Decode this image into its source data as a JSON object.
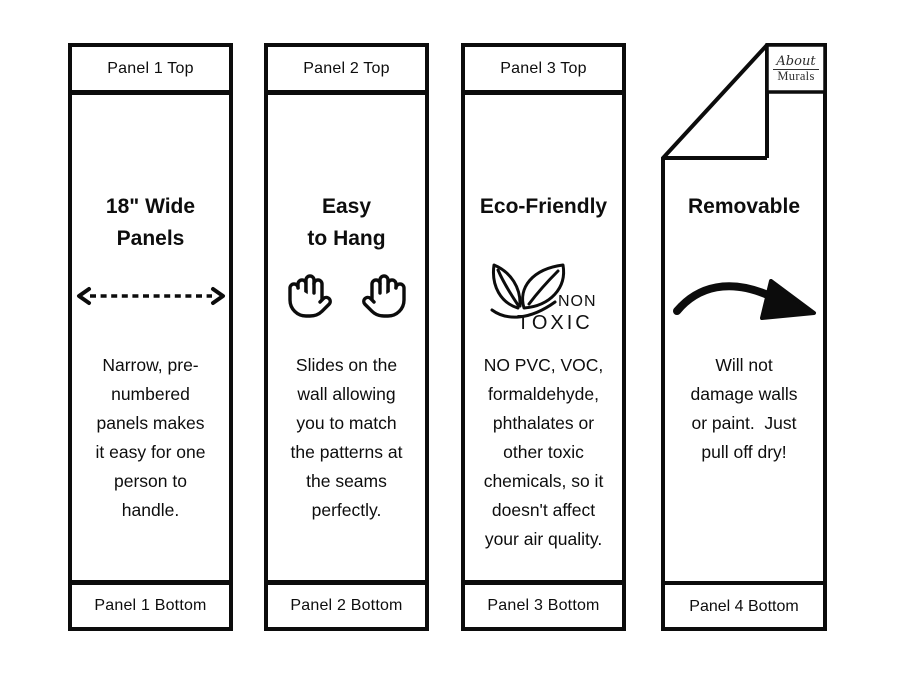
{
  "page": {
    "background": "#ffffff",
    "ink": "#0c0c0c"
  },
  "panels": [
    {
      "top_label": "Panel 1 Top",
      "title": "18\" Wide\nPanels",
      "icon": "width-arrow-icon",
      "body": "Narrow, pre-\nnumbered\npanels makes\nit easy for one\nperson to\nhandle.",
      "bottom_label": "Panel 1 Bottom"
    },
    {
      "top_label": "Panel 2 Top",
      "title": "Easy\nto Hang",
      "icon": "two-hands-icon",
      "body": "Slides on the\nwall allowing\nyou to match\nthe patterns at\nthe seams\nperfectly.",
      "bottom_label": "Panel 2 Bottom"
    },
    {
      "top_label": "Panel 3 Top",
      "title": "Eco-Friendly",
      "icon": "non-toxic-leaf-icon",
      "icon_text": {
        "line1": "NON",
        "line2": "TOXIC"
      },
      "body": "NO PVC, VOC,\nformaldehyde,\nphthalates or\nother toxic\nchemicals, so it\ndoesn't affect\nyour air quality.",
      "bottom_label": "Panel 3 Bottom"
    },
    {
      "title": "Removable",
      "icon": "curved-arrow-icon",
      "body": "Will not\ndamage walls\nor paint.  Just\npull off dry!",
      "bottom_label": "Panel 4 Bottom",
      "logo": {
        "line1": "About",
        "line2": "Murals"
      }
    }
  ]
}
